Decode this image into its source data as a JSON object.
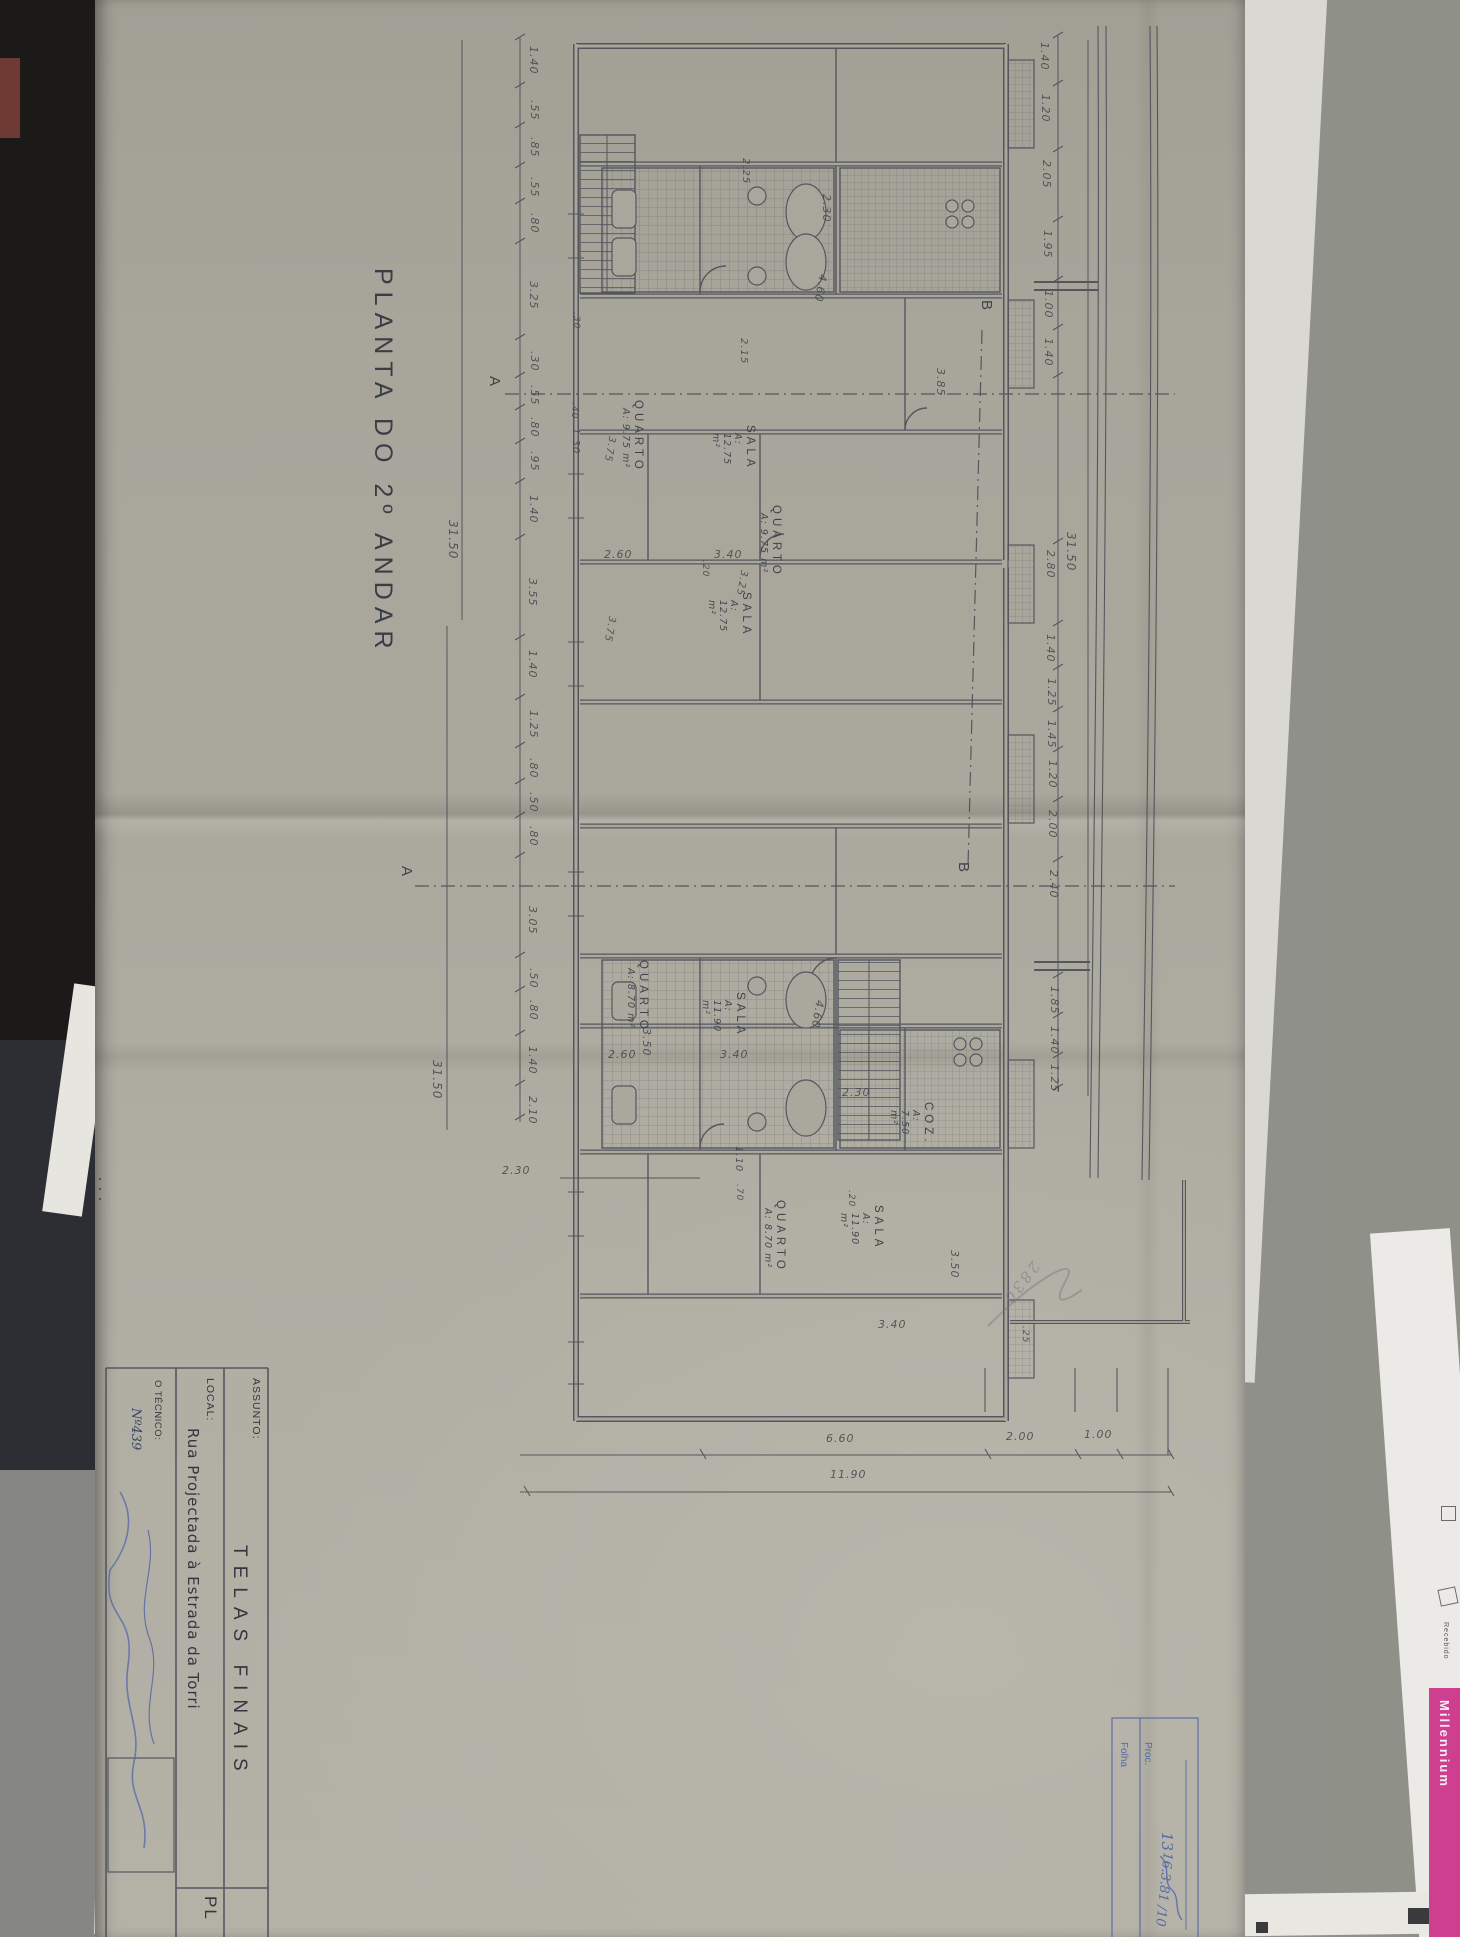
{
  "title": {
    "text": "PLANTA DO 2º ANDAR"
  },
  "title_block": {
    "assunto_label": "ASSUNTO:",
    "assunto_value": "TELAS FINAIS",
    "local_label": "LOCAL:",
    "local_value": "Rua Projectada à Estrada da Torri",
    "tecnico_label": "O TÉCNICO:",
    "tecnico_value": "Nº439",
    "sheet_code": "PL"
  },
  "stamp_box": {
    "folha_label": "Folha",
    "folha_value": "13",
    "proc_label": "Proc.",
    "proc_value": "16.3.81 /10"
  },
  "background": {
    "millennium": "Millennium",
    "recebido": "Recebido"
  },
  "scribble": {
    "text": "2830"
  },
  "section_markers": [
    {
      "t": "A",
      "x": 486,
      "y": 376
    },
    {
      "t": "A",
      "x": 398,
      "y": 866
    },
    {
      "t": "B",
      "x": 978,
      "y": 300
    },
    {
      "t": "B",
      "x": 955,
      "y": 862
    }
  ],
  "room_labels": [
    {
      "name": "QUARTO",
      "area": "A: 9.75 m²",
      "x": 632,
      "y": 400
    },
    {
      "name": "SALA",
      "area": "A: 12.75 m²",
      "x": 744,
      "y": 425
    },
    {
      "name": "QUARTO",
      "area": "A: 9.75 m²",
      "x": 770,
      "y": 505
    },
    {
      "name": "SALA",
      "area": "A: 12.75 m²",
      "x": 740,
      "y": 592
    },
    {
      "name": "QUARTO",
      "area": "A: 8.70 m²",
      "x": 637,
      "y": 960
    },
    {
      "name": "SALA",
      "area": "A: 11.90 m²",
      "x": 734,
      "y": 992
    },
    {
      "name": "QUARTO",
      "area": "A: 8.70 m²",
      "x": 774,
      "y": 1200
    },
    {
      "name": "SALA",
      "area": "A: 11.90 m²",
      "x": 872,
      "y": 1205
    },
    {
      "name": "COZ.",
      "area": "A: 7.50 m²",
      "x": 922,
      "y": 1102
    }
  ],
  "dimensions": [
    {
      "t": "1.40",
      "x": 527,
      "y": 46,
      "o": "v"
    },
    {
      "t": ".55",
      "x": 528,
      "y": 100,
      "o": "v"
    },
    {
      "t": ".85",
      "x": 528,
      "y": 137,
      "o": "v"
    },
    {
      "t": ".55",
      "x": 528,
      "y": 177,
      "o": "v"
    },
    {
      "t": ".80",
      "x": 528,
      "y": 213,
      "o": "v"
    },
    {
      "t": "3.25",
      "x": 527,
      "y": 281,
      "o": "v"
    },
    {
      "t": ".30",
      "x": 528,
      "y": 351,
      "o": "v"
    },
    {
      "t": ".55",
      "x": 528,
      "y": 385,
      "o": "v"
    },
    {
      "t": ".80",
      "x": 528,
      "y": 417,
      "o": "v"
    },
    {
      "t": ".95",
      "x": 528,
      "y": 451,
      "o": "v"
    },
    {
      "t": "1.40",
      "x": 527,
      "y": 495,
      "o": "v"
    },
    {
      "t": "3.55",
      "x": 526,
      "y": 578,
      "o": "v"
    },
    {
      "t": "1.40",
      "x": 526,
      "y": 650,
      "o": "v"
    },
    {
      "t": "1.25",
      "x": 527,
      "y": 710,
      "o": "v"
    },
    {
      "t": ".80",
      "x": 527,
      "y": 758,
      "o": "v"
    },
    {
      "t": ".50",
      "x": 527,
      "y": 792,
      "o": "v"
    },
    {
      "t": ".80",
      "x": 527,
      "y": 826,
      "o": "v"
    },
    {
      "t": "3.05",
      "x": 526,
      "y": 906,
      "o": "v"
    },
    {
      "t": ".50",
      "x": 527,
      "y": 968,
      "o": "v"
    },
    {
      "t": ".80",
      "x": 527,
      "y": 1000,
      "o": "v"
    },
    {
      "t": "1.40",
      "x": 526,
      "y": 1046,
      "o": "v"
    },
    {
      "t": "2.10",
      "x": 526,
      "y": 1096,
      "o": "v"
    },
    {
      "t": "31.50",
      "x": 446,
      "y": 520,
      "o": "v",
      "s": 12
    },
    {
      "t": "31.50",
      "x": 430,
      "y": 1060,
      "o": "v",
      "s": 12
    },
    {
      "t": "1.40",
      "x": 1038,
      "y": 42,
      "o": "v"
    },
    {
      "t": "1.20",
      "x": 1039,
      "y": 94,
      "o": "v"
    },
    {
      "t": "2.05",
      "x": 1040,
      "y": 160,
      "o": "v"
    },
    {
      "t": "1.95",
      "x": 1041,
      "y": 230,
      "o": "v"
    },
    {
      "t": "1.00",
      "x": 1042,
      "y": 290,
      "o": "v"
    },
    {
      "t": "1.40",
      "x": 1042,
      "y": 338,
      "o": "v"
    },
    {
      "t": "2.80",
      "x": 1044,
      "y": 550,
      "o": "v"
    },
    {
      "t": "1.40",
      "x": 1044,
      "y": 634,
      "o": "v"
    },
    {
      "t": "1.25",
      "x": 1045,
      "y": 678,
      "o": "v"
    },
    {
      "t": "1.45",
      "x": 1045,
      "y": 720,
      "o": "v"
    },
    {
      "t": "1.20",
      "x": 1046,
      "y": 760,
      "o": "v"
    },
    {
      "t": "2.00",
      "x": 1046,
      "y": 810,
      "o": "v"
    },
    {
      "t": "2.40",
      "x": 1047,
      "y": 870,
      "o": "v"
    },
    {
      "t": "1.85",
      "x": 1048,
      "y": 986,
      "o": "v"
    },
    {
      "t": "1.40",
      "x": 1048,
      "y": 1026,
      "o": "v"
    },
    {
      "t": "1.25",
      "x": 1048,
      "y": 1064,
      "o": "v"
    },
    {
      "t": "31.50",
      "x": 1064,
      "y": 532,
      "o": "v",
      "s": 12
    },
    {
      "t": "6.60",
      "x": 826,
      "y": 1432,
      "o": "h"
    },
    {
      "t": "2.00",
      "x": 1006,
      "y": 1430,
      "o": "h"
    },
    {
      "t": "1.00",
      "x": 1084,
      "y": 1428,
      "o": "h"
    },
    {
      "t": "11.90",
      "x": 830,
      "y": 1468,
      "o": "h"
    },
    {
      "t": "2.30",
      "x": 502,
      "y": 1164,
      "o": "h"
    },
    {
      "t": "2.30",
      "x": 842,
      "y": 1086,
      "o": "h"
    },
    {
      "t": "3.40",
      "x": 878,
      "y": 1318,
      "o": "h"
    },
    {
      "t": ".25",
      "x": 1020,
      "y": 1326,
      "o": "v",
      "s": 9
    },
    {
      "t": "2.60",
      "x": 604,
      "y": 548,
      "o": "h"
    },
    {
      "t": "3.40",
      "x": 714,
      "y": 548,
      "o": "h"
    },
    {
      "t": "2.60",
      "x": 608,
      "y": 1048,
      "o": "h"
    },
    {
      "t": "3.40",
      "x": 720,
      "y": 1048,
      "o": "h"
    },
    {
      "t": "3.50",
      "x": 640,
      "y": 1028,
      "o": "v"
    },
    {
      "t": "3.50",
      "x": 948,
      "y": 1250,
      "o": "v"
    },
    {
      "t": ".30",
      "x": 571,
      "y": 312,
      "o": "v",
      "s": 9
    },
    {
      "t": ".40",
      "x": 569,
      "y": 402,
      "o": "v",
      "s": 9
    },
    {
      "t": "1.30",
      "x": 570,
      "y": 428,
      "o": "v",
      "s": 10
    },
    {
      "t": "3.75",
      "x": 604,
      "y": 436,
      "o": "d",
      "s": 10
    },
    {
      "t": "3.75",
      "x": 604,
      "y": 616,
      "o": "d",
      "s": 10
    },
    {
      "t": "3.25",
      "x": 736,
      "y": 570,
      "o": "d",
      "s": 10
    },
    {
      "t": "2.25",
      "x": 740,
      "y": 158,
      "o": "v",
      "s": 10
    },
    {
      "t": "2.15",
      "x": 738,
      "y": 338,
      "o": "v",
      "s": 10
    },
    {
      "t": "4.60",
      "x": 814,
      "y": 274,
      "o": "d"
    },
    {
      "t": "4.60",
      "x": 811,
      "y": 1000,
      "o": "d"
    },
    {
      "t": "2.30",
      "x": 820,
      "y": 194,
      "o": "v"
    },
    {
      "t": "3.85",
      "x": 934,
      "y": 368,
      "o": "v"
    },
    {
      "t": "1.10",
      "x": 733,
      "y": 1146,
      "o": "v",
      "s": 10
    },
    {
      "t": ".70",
      "x": 734,
      "y": 1184,
      "o": "v",
      "s": 9
    },
    {
      "t": ".20",
      "x": 700,
      "y": 560,
      "o": "v",
      "s": 9
    },
    {
      "t": ".20",
      "x": 846,
      "y": 1190,
      "o": "v",
      "s": 9
    }
  ]
}
